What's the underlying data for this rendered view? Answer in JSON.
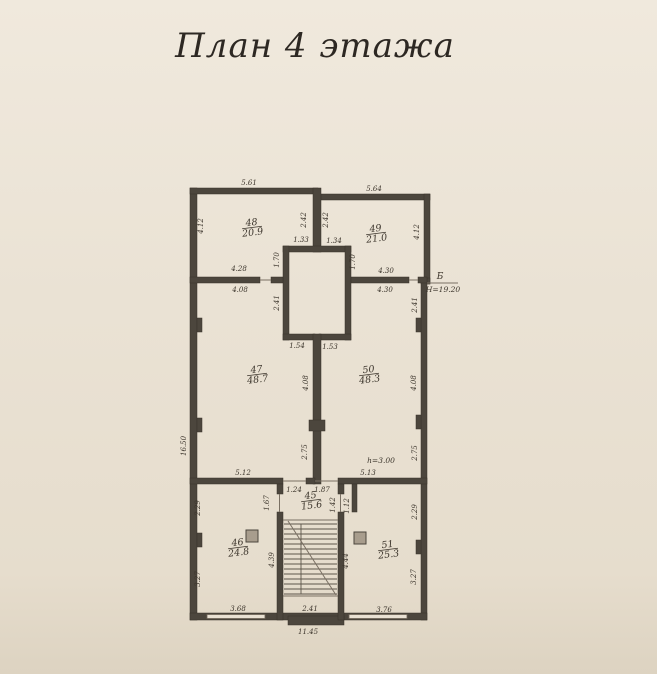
{
  "title": "План 4 этажа",
  "colors": {
    "paper": "#e9e1d3",
    "ink": "#3b342b",
    "wall": "#4c463d"
  },
  "rooms": [
    {
      "number": "48",
      "area": "20.9",
      "x": 252,
      "y": 227
    },
    {
      "number": "49",
      "area": "21.0",
      "x": 376,
      "y": 233
    },
    {
      "number": "47",
      "area": "48.7",
      "x": 257,
      "y": 374
    },
    {
      "number": "50",
      "area": "48.3",
      "x": 369,
      "y": 374
    },
    {
      "number": "45",
      "area": "15.6",
      "x": 311,
      "y": 500
    },
    {
      "number": "46",
      "area": "24.8",
      "x": 238,
      "y": 547
    },
    {
      "number": "51",
      "area": "25.3",
      "x": 388,
      "y": 549
    }
  ],
  "marks": {
    "axis": "Б",
    "elevation": "Н=19.20",
    "ceiling_height": "h=3.00"
  },
  "labels": [
    {
      "n": "dim",
      "t": "5.61",
      "x": 249,
      "y": 185
    },
    {
      "n": "dim",
      "t": "5.64",
      "x": 374,
      "y": 191
    },
    {
      "n": "dim",
      "t": "2.42",
      "x": 306,
      "y": 220,
      "r": -90
    },
    {
      "n": "dim",
      "t": "2.42",
      "x": 328,
      "y": 220,
      "r": -90
    },
    {
      "n": "dim",
      "t": "4.12",
      "x": 203,
      "y": 226,
      "r": -90
    },
    {
      "n": "dim",
      "t": "4.12",
      "x": 419,
      "y": 232,
      "r": -90
    },
    {
      "n": "dim",
      "t": "1.33",
      "x": 301,
      "y": 242
    },
    {
      "n": "dim",
      "t": "1.34",
      "x": 334,
      "y": 243
    },
    {
      "n": "dim",
      "t": "1.70",
      "x": 279,
      "y": 260,
      "r": -90
    },
    {
      "n": "dim",
      "t": "1.70",
      "x": 355,
      "y": 262,
      "r": -90
    },
    {
      "n": "dim",
      "t": "4.28",
      "x": 239,
      "y": 271
    },
    {
      "n": "dim",
      "t": "4.08",
      "x": 240,
      "y": 292
    },
    {
      "n": "dim",
      "t": "4.30",
      "x": 386,
      "y": 273
    },
    {
      "n": "dim",
      "t": "4.30",
      "x": 385,
      "y": 292
    },
    {
      "n": "dim",
      "t": "2.41",
      "x": 279,
      "y": 303,
      "r": -90
    },
    {
      "n": "dim",
      "t": "2.41",
      "x": 417,
      "y": 305,
      "r": -90
    },
    {
      "n": "dim",
      "t": "1.54",
      "x": 297,
      "y": 348
    },
    {
      "n": "dim",
      "t": "1.53",
      "x": 330,
      "y": 349
    },
    {
      "n": "dim",
      "t": "4.08",
      "x": 308,
      "y": 383,
      "r": -90
    },
    {
      "n": "dim",
      "t": "4.08",
      "x": 416,
      "y": 383,
      "r": -90
    },
    {
      "n": "dim",
      "t": "16.50",
      "x": 186,
      "y": 446,
      "r": -90
    },
    {
      "n": "dim",
      "t": "2.75",
      "x": 307,
      "y": 452,
      "r": -90
    },
    {
      "n": "dim",
      "t": "2.75",
      "x": 417,
      "y": 453,
      "r": -90
    },
    {
      "n": "note",
      "t": "h=3.00",
      "x": 381,
      "y": 463
    },
    {
      "n": "dim",
      "t": "5.12",
      "x": 243,
      "y": 475
    },
    {
      "n": "dim",
      "t": "5.13",
      "x": 368,
      "y": 475
    },
    {
      "n": "dim",
      "t": "1.24",
      "x": 294,
      "y": 492
    },
    {
      "n": "dim",
      "t": "1.87",
      "x": 322,
      "y": 492
    },
    {
      "n": "dim",
      "t": "1.67",
      "x": 269,
      "y": 503,
      "r": -90
    },
    {
      "n": "dim",
      "t": "1.42",
      "x": 335,
      "y": 505,
      "r": -90
    },
    {
      "n": "dim",
      "t": "1.12",
      "x": 349,
      "y": 506,
      "r": -90
    },
    {
      "n": "dim",
      "t": "2.29",
      "x": 200,
      "y": 508,
      "r": -90
    },
    {
      "n": "dim",
      "t": "2.29",
      "x": 417,
      "y": 512,
      "r": -90
    },
    {
      "n": "dim",
      "t": "4.39",
      "x": 274,
      "y": 560,
      "r": -90
    },
    {
      "n": "dim",
      "t": "4.44",
      "x": 348,
      "y": 561,
      "r": -90
    },
    {
      "n": "dim",
      "t": "3.27",
      "x": 200,
      "y": 579,
      "r": -90
    },
    {
      "n": "dim",
      "t": "3.27",
      "x": 416,
      "y": 577,
      "r": -90
    },
    {
      "n": "dim",
      "t": "3.68",
      "x": 238,
      "y": 611
    },
    {
      "n": "dim",
      "t": "2.41",
      "x": 310,
      "y": 611
    },
    {
      "n": "dim",
      "t": "3.76",
      "x": 384,
      "y": 612
    },
    {
      "n": "dim",
      "t": "11.45",
      "x": 308,
      "y": 634
    },
    {
      "n": "axis",
      "t": "Б",
      "x": 440,
      "y": 279
    },
    {
      "n": "level",
      "t": "Н=19.20",
      "x": 443,
      "y": 292
    }
  ]
}
